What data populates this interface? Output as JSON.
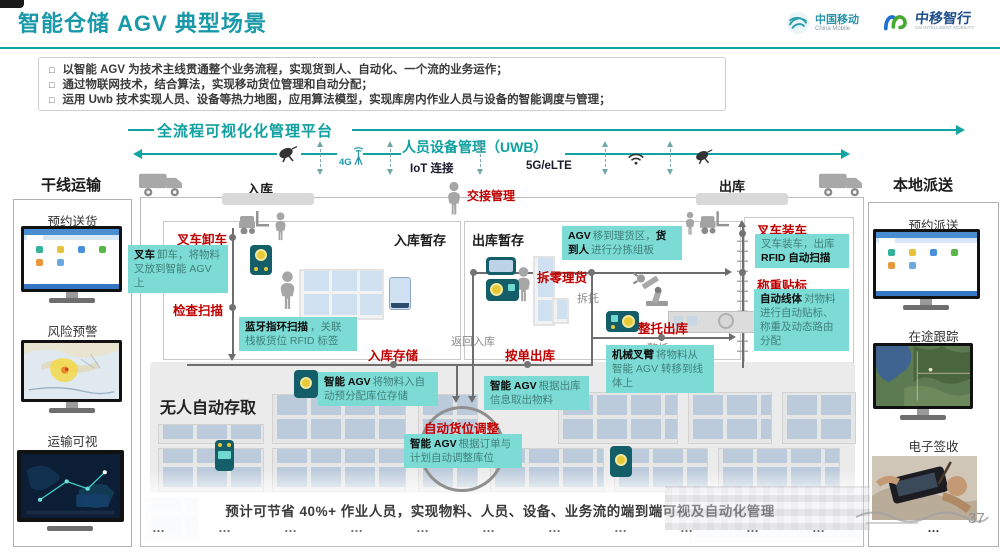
{
  "slide": {
    "title": "智能仓储 AGV 典型场景",
    "page_number": "37",
    "bullet_marker": "□",
    "logos": {
      "cm_name": "中国移动",
      "cm_sub": "China Mobile",
      "partner_name": "中移智行",
      "partner_sub": "CM INTELLIGENT MOBILITY"
    },
    "bullets": [
      "以智能 AGV 为技术主线贯通整个业务流程，实现货到人、自动化、一个流的业务运作；",
      "通过物联网技术，结合算法，实现移动货位管理和自动分配；",
      "运用 Uwb 技术实现人员、设备等热力地图，应用算法模型，实现库房内作业人员与设备的智能调度与管理；"
    ],
    "colors": {
      "accent_teal": "#12a3a3",
      "red": "#c00000",
      "note_bg": "#7cdbd4"
    }
  },
  "platform": {
    "full_label": "全流程可视化化管理平台",
    "uwb_label": "人员设备管理（UWB）",
    "iot_label": "IoT 连接",
    "g4_label": "4G",
    "g5_label": "5G/eLTE"
  },
  "lanes": {
    "trunk": "干线运输",
    "local": "本地派送",
    "inbound": "入库",
    "outbound": "出库"
  },
  "left_panel": {
    "items": [
      "预约送货",
      "风险预警",
      "运输可视"
    ]
  },
  "right_panel": {
    "items": [
      "预约派送",
      "在途跟踪",
      "电子签收"
    ],
    "more": "…"
  },
  "flow": {
    "zones": {
      "inbound_staging": "入库暂存",
      "outbound_staging": "出库暂存",
      "auto_storage": "无人自动存取"
    },
    "steps": {
      "unload": "叉车卸车",
      "check": "检查扫描",
      "store": "入库存储",
      "order_out": "按单出库",
      "pick": "拆零理货",
      "pallet_out": "整托出库",
      "relocate": "自动货位调整",
      "load": "叉车装车",
      "weigh": "称重贴标",
      "handover": "交接管理"
    },
    "tags": {
      "depalletize": "拆托",
      "palletize": "整托",
      "return_in": "返回入库"
    },
    "notes": {
      "n1": {
        "b": "叉车",
        "t": "卸车，将物料叉放到智能 AGV 上"
      },
      "n2": {
        "b": "蓝牙指环扫描",
        "t": "，关联栈板货位 RFID 标签"
      },
      "n3": {
        "b1": "AGV",
        "t1": "移到理货区，",
        "b2": "货到人",
        "t2": "进行分拣组板"
      },
      "n4": {
        "t": "叉车装车，出库",
        "b": "RFID 自动扫描"
      },
      "n5": {
        "b": "自动线体",
        "t": "对物料进行自动贴标、称重及动态路由分配"
      },
      "n6": {
        "b": "智能 AGV",
        "t": "将物料入自动预分配库位存储"
      },
      "n7": {
        "b": "智能 AGV",
        "t": "根据出库信息取出物料"
      },
      "n8": {
        "b": "机械叉臂",
        "t": "将物料从智能 AGV 转移到线体上"
      },
      "n9": {
        "b": "智能 AGV",
        "t": "根据订单与计划自动调整库位"
      }
    }
  },
  "footer": {
    "caption": "预计可节省 40%+ 作业人员，实现物料、人员、设备、业务流的端到端可视及自动化管理",
    "dots": "…"
  }
}
